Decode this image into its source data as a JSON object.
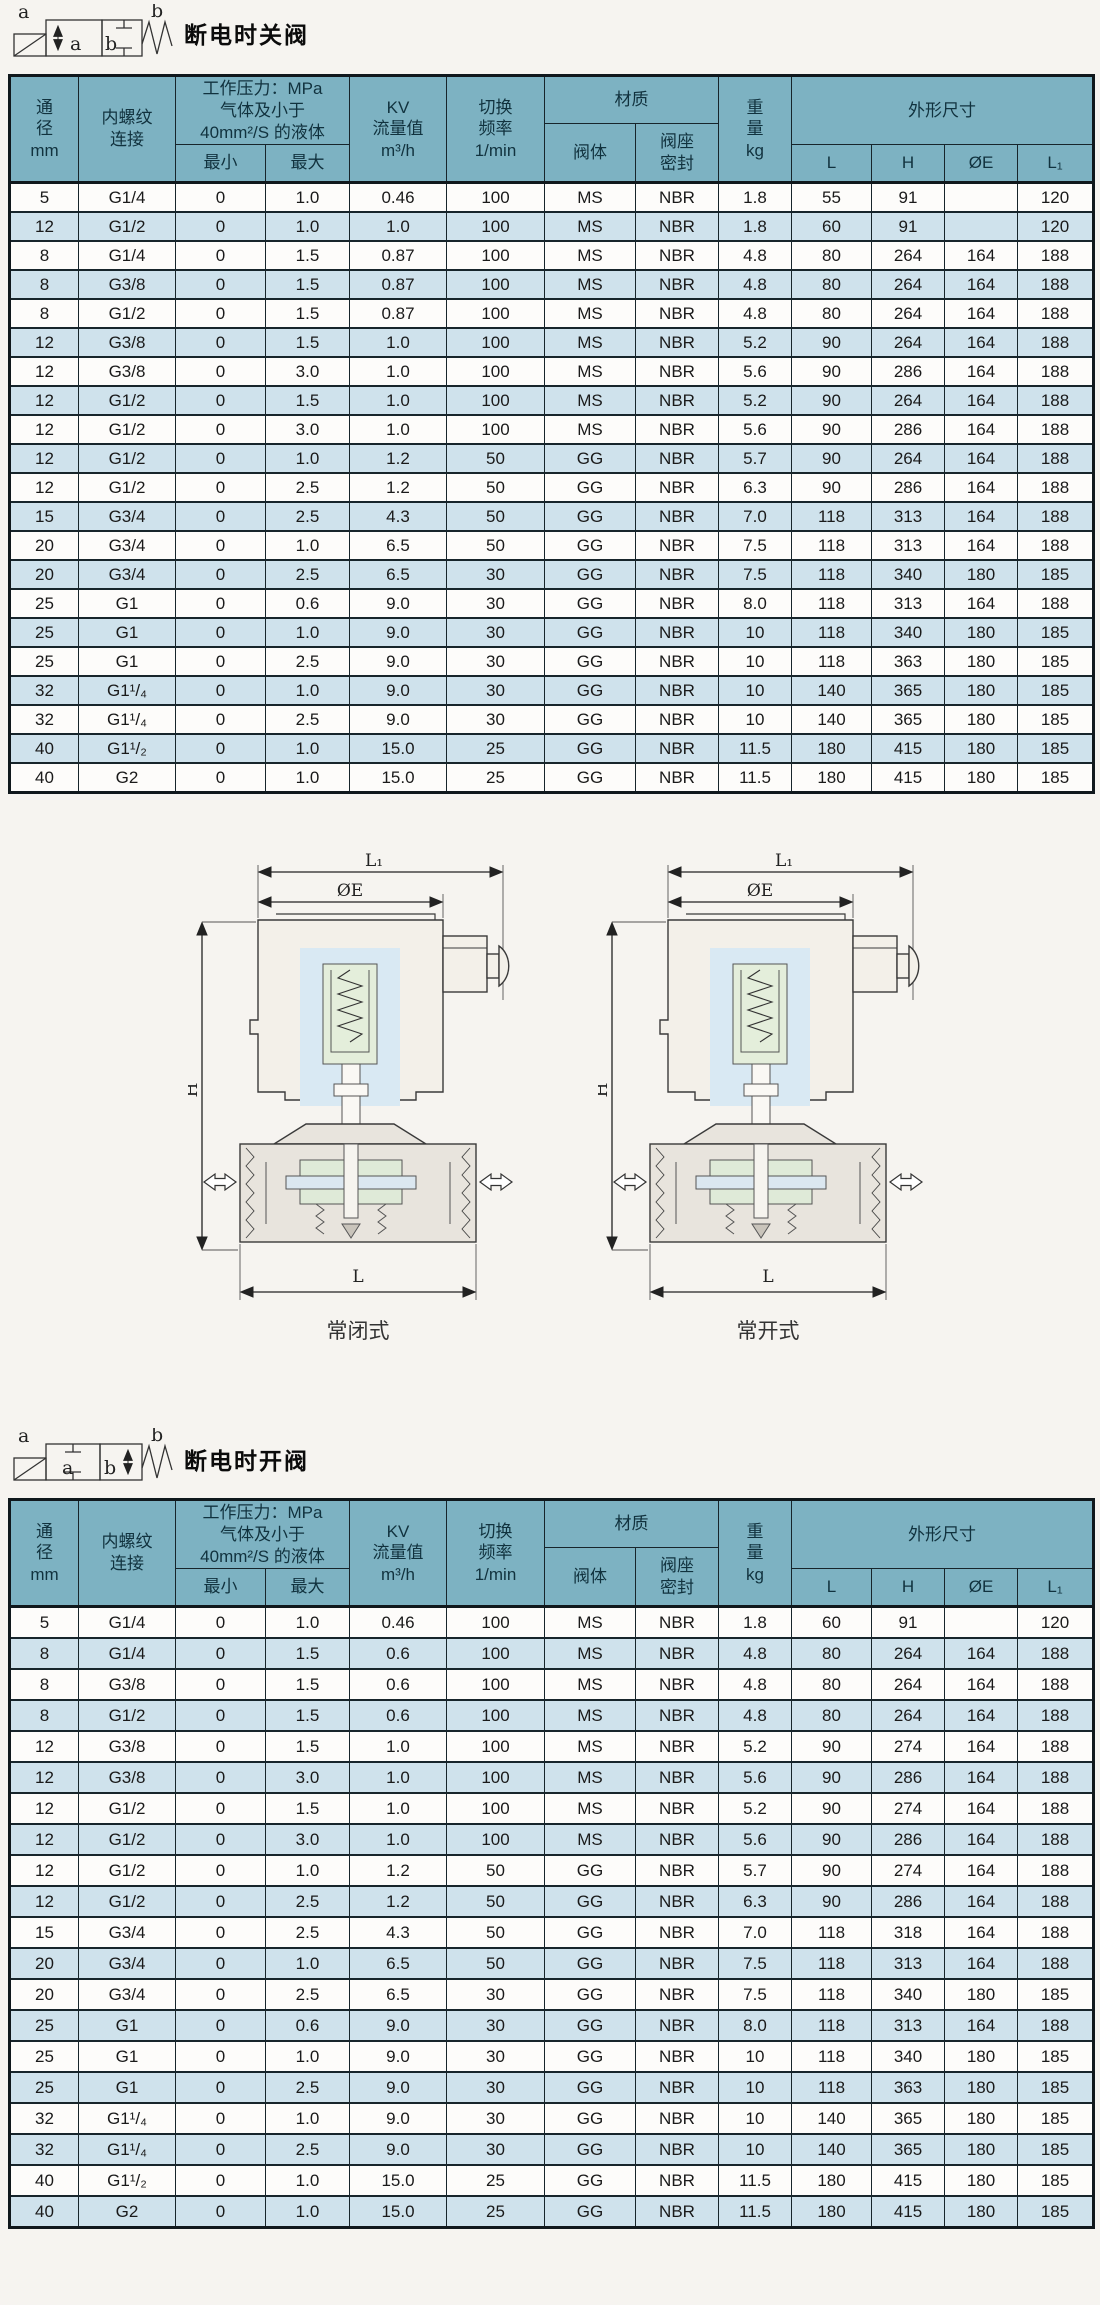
{
  "colors": {
    "header_bg": "#7db2c2",
    "row_bg": "#fdfcfa",
    "row_alt_bg": "#cfe2ec",
    "page_bg": "#f6f4f0",
    "border": "#17252b"
  },
  "section1": {
    "title": "断电时关阀",
    "symbol": {
      "top_left": "a",
      "top_right": "b",
      "box_a": "a",
      "box_b": "b"
    }
  },
  "section2": {
    "title": "断电时开阀",
    "symbol": {
      "top_left": "a",
      "top_right": "b",
      "box_a": "a",
      "box_b": "b"
    }
  },
  "table_header": {
    "dn": [
      "通",
      "径",
      "mm"
    ],
    "thread": [
      "内螺纹",
      "连接"
    ],
    "pressure_group": [
      "工作压力：MPa",
      "气体及小于",
      "40mm²/S 的液体"
    ],
    "pressure_min": "最小",
    "pressure_max": "最大",
    "kv": [
      "KV",
      "流量值",
      "m³/h"
    ],
    "freq": [
      "切换",
      "频率",
      "1/min"
    ],
    "material_group": "材质",
    "material_body": "阀体",
    "material_seal": [
      "阀座",
      "密封"
    ],
    "weight": [
      "重",
      "量",
      "kg"
    ],
    "dims_group": "外形尺寸",
    "dim_l": "L",
    "dim_h": "H",
    "dim_e": "ØE",
    "dim_l1": "L₁"
  },
  "table1_rows": [
    [
      "5",
      "G1/4",
      "0",
      "1.0",
      "0.46",
      "100",
      "MS",
      "NBR",
      "1.8",
      "55",
      "91",
      "",
      "120"
    ],
    [
      "12",
      "G1/2",
      "0",
      "1.0",
      "1.0",
      "100",
      "MS",
      "NBR",
      "1.8",
      "60",
      "91",
      "",
      "120"
    ],
    [
      "8",
      "G1/4",
      "0",
      "1.5",
      "0.87",
      "100",
      "MS",
      "NBR",
      "4.8",
      "80",
      "264",
      "164",
      "188"
    ],
    [
      "8",
      "G3/8",
      "0",
      "1.5",
      "0.87",
      "100",
      "MS",
      "NBR",
      "4.8",
      "80",
      "264",
      "164",
      "188"
    ],
    [
      "8",
      "G1/2",
      "0",
      "1.5",
      "0.87",
      "100",
      "MS",
      "NBR",
      "4.8",
      "80",
      "264",
      "164",
      "188"
    ],
    [
      "12",
      "G3/8",
      "0",
      "1.5",
      "1.0",
      "100",
      "MS",
      "NBR",
      "5.2",
      "90",
      "264",
      "164",
      "188"
    ],
    [
      "12",
      "G3/8",
      "0",
      "3.0",
      "1.0",
      "100",
      "MS",
      "NBR",
      "5.6",
      "90",
      "286",
      "164",
      "188"
    ],
    [
      "12",
      "G1/2",
      "0",
      "1.5",
      "1.0",
      "100",
      "MS",
      "NBR",
      "5.2",
      "90",
      "264",
      "164",
      "188"
    ],
    [
      "12",
      "G1/2",
      "0",
      "3.0",
      "1.0",
      "100",
      "MS",
      "NBR",
      "5.6",
      "90",
      "286",
      "164",
      "188"
    ],
    [
      "12",
      "G1/2",
      "0",
      "1.0",
      "1.2",
      "50",
      "GG",
      "NBR",
      "5.7",
      "90",
      "264",
      "164",
      "188"
    ],
    [
      "12",
      "G1/2",
      "0",
      "2.5",
      "1.2",
      "50",
      "GG",
      "NBR",
      "6.3",
      "90",
      "286",
      "164",
      "188"
    ],
    [
      "15",
      "G3/4",
      "0",
      "2.5",
      "4.3",
      "50",
      "GG",
      "NBR",
      "7.0",
      "118",
      "313",
      "164",
      "188"
    ],
    [
      "20",
      "G3/4",
      "0",
      "1.0",
      "6.5",
      "50",
      "GG",
      "NBR",
      "7.5",
      "118",
      "313",
      "164",
      "188"
    ],
    [
      "20",
      "G3/4",
      "0",
      "2.5",
      "6.5",
      "30",
      "GG",
      "NBR",
      "7.5",
      "118",
      "340",
      "180",
      "185"
    ],
    [
      "25",
      "G1",
      "0",
      "0.6",
      "9.0",
      "30",
      "GG",
      "NBR",
      "8.0",
      "118",
      "313",
      "164",
      "188"
    ],
    [
      "25",
      "G1",
      "0",
      "1.0",
      "9.0",
      "30",
      "GG",
      "NBR",
      "10",
      "118",
      "340",
      "180",
      "185"
    ],
    [
      "25",
      "G1",
      "0",
      "2.5",
      "9.0",
      "30",
      "GG",
      "NBR",
      "10",
      "118",
      "363",
      "180",
      "185"
    ],
    [
      "32",
      "G1¹/₄",
      "0",
      "1.0",
      "9.0",
      "30",
      "GG",
      "NBR",
      "10",
      "140",
      "365",
      "180",
      "185"
    ],
    [
      "32",
      "G1¹/₄",
      "0",
      "2.5",
      "9.0",
      "30",
      "GG",
      "NBR",
      "10",
      "140",
      "365",
      "180",
      "185"
    ],
    [
      "40",
      "G1¹/₂",
      "0",
      "1.0",
      "15.0",
      "25",
      "GG",
      "NBR",
      "11.5",
      "180",
      "415",
      "180",
      "185"
    ],
    [
      "40",
      "G2",
      "0",
      "1.0",
      "15.0",
      "25",
      "GG",
      "NBR",
      "11.5",
      "180",
      "415",
      "180",
      "185"
    ]
  ],
  "table2_rows": [
    [
      "5",
      "G1/4",
      "0",
      "1.0",
      "0.46",
      "100",
      "MS",
      "NBR",
      "1.8",
      "60",
      "91",
      "",
      "120"
    ],
    [
      "8",
      "G1/4",
      "0",
      "1.5",
      "0.6",
      "100",
      "MS",
      "NBR",
      "4.8",
      "80",
      "264",
      "164",
      "188"
    ],
    [
      "8",
      "G3/8",
      "0",
      "1.5",
      "0.6",
      "100",
      "MS",
      "NBR",
      "4.8",
      "80",
      "264",
      "164",
      "188"
    ],
    [
      "8",
      "G1/2",
      "0",
      "1.5",
      "0.6",
      "100",
      "MS",
      "NBR",
      "4.8",
      "80",
      "264",
      "164",
      "188"
    ],
    [
      "12",
      "G3/8",
      "0",
      "1.5",
      "1.0",
      "100",
      "MS",
      "NBR",
      "5.2",
      "90",
      "274",
      "164",
      "188"
    ],
    [
      "12",
      "G3/8",
      "0",
      "3.0",
      "1.0",
      "100",
      "MS",
      "NBR",
      "5.6",
      "90",
      "286",
      "164",
      "188"
    ],
    [
      "12",
      "G1/2",
      "0",
      "1.5",
      "1.0",
      "100",
      "MS",
      "NBR",
      "5.2",
      "90",
      "274",
      "164",
      "188"
    ],
    [
      "12",
      "G1/2",
      "0",
      "3.0",
      "1.0",
      "100",
      "MS",
      "NBR",
      "5.6",
      "90",
      "286",
      "164",
      "188"
    ],
    [
      "12",
      "G1/2",
      "0",
      "1.0",
      "1.2",
      "50",
      "GG",
      "NBR",
      "5.7",
      "90",
      "274",
      "164",
      "188"
    ],
    [
      "12",
      "G1/2",
      "0",
      "2.5",
      "1.2",
      "50",
      "GG",
      "NBR",
      "6.3",
      "90",
      "286",
      "164",
      "188"
    ],
    [
      "15",
      "G3/4",
      "0",
      "2.5",
      "4.3",
      "50",
      "GG",
      "NBR",
      "7.0",
      "118",
      "318",
      "164",
      "188"
    ],
    [
      "20",
      "G3/4",
      "0",
      "1.0",
      "6.5",
      "50",
      "GG",
      "NBR",
      "7.5",
      "118",
      "313",
      "164",
      "188"
    ],
    [
      "20",
      "G3/4",
      "0",
      "2.5",
      "6.5",
      "30",
      "GG",
      "NBR",
      "7.5",
      "118",
      "340",
      "180",
      "185"
    ],
    [
      "25",
      "G1",
      "0",
      "0.6",
      "9.0",
      "30",
      "GG",
      "NBR",
      "8.0",
      "118",
      "313",
      "164",
      "188"
    ],
    [
      "25",
      "G1",
      "0",
      "1.0",
      "9.0",
      "30",
      "GG",
      "NBR",
      "10",
      "118",
      "340",
      "180",
      "185"
    ],
    [
      "25",
      "G1",
      "0",
      "2.5",
      "9.0",
      "30",
      "GG",
      "NBR",
      "10",
      "118",
      "363",
      "180",
      "185"
    ],
    [
      "32",
      "G1¹/₄",
      "0",
      "1.0",
      "9.0",
      "30",
      "GG",
      "NBR",
      "10",
      "140",
      "365",
      "180",
      "185"
    ],
    [
      "32",
      "G1¹/₄",
      "0",
      "2.5",
      "9.0",
      "30",
      "GG",
      "NBR",
      "10",
      "140",
      "365",
      "180",
      "185"
    ],
    [
      "40",
      "G1¹/₂",
      "0",
      "1.0",
      "15.0",
      "25",
      "GG",
      "NBR",
      "11.5",
      "180",
      "415",
      "180",
      "185"
    ],
    [
      "40",
      "G2",
      "0",
      "1.0",
      "15.0",
      "25",
      "GG",
      "NBR",
      "11.5",
      "180",
      "415",
      "180",
      "185"
    ]
  ],
  "diagrams": [
    {
      "caption": "常闭式",
      "dim_l1": "L₁",
      "dim_e": "ØE",
      "dim_h": "H",
      "dim_l": "L"
    },
    {
      "caption": "常开式",
      "dim_l1": "L₁",
      "dim_e": "ØE",
      "dim_h": "H",
      "dim_l": "L"
    }
  ]
}
